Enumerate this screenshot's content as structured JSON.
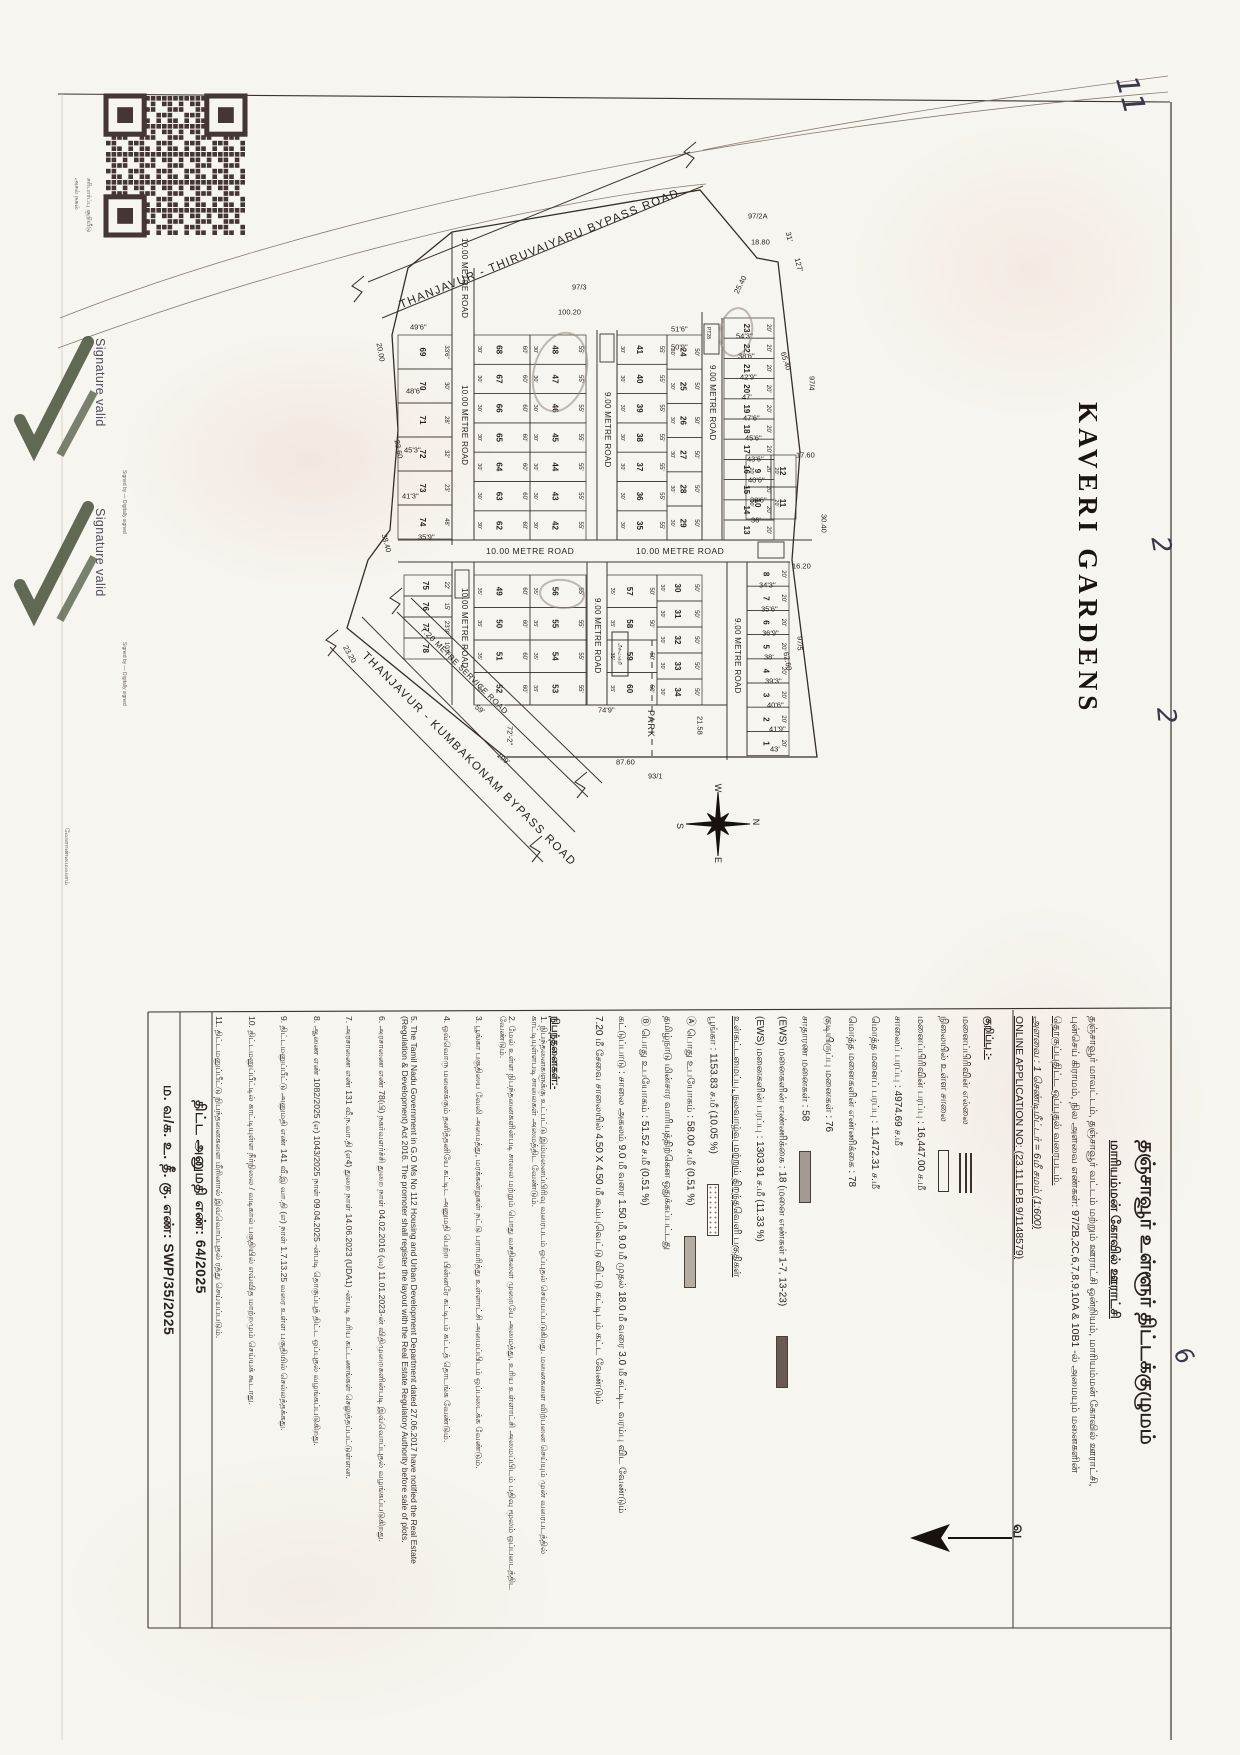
{
  "map": {
    "title_vertical": "KAVERI GARDENS",
    "park_label": "PARK",
    "north_label": "வ",
    "compass_letters": [
      "W",
      "N",
      "S",
      "E"
    ],
    "road_labels": [
      {
        "text": "THANJAVUR - THIRUVAIYARU BYPASS ROAD",
        "x": 398,
        "y": 300,
        "r": -22,
        "s": 11.5,
        "ls": 1.5
      },
      {
        "text": "THANJAVUR - KUMBAKONAM BYPASS ROAD",
        "x": 368,
        "y": 650,
        "r": 45,
        "s": 11.5,
        "ls": 1.5
      },
      {
        "text": "7.20 METRE SERVICE ROAD",
        "x": 425,
        "y": 625,
        "r": 45,
        "s": 8,
        "ls": 0.5
      },
      {
        "text": "10.00 METRE ROAD",
        "x": 469,
        "y": 238,
        "r": 90,
        "s": 8,
        "ls": 0.3
      },
      {
        "text": "10.00 METRE ROAD",
        "x": 469,
        "y": 385,
        "r": 90,
        "s": 8,
        "ls": 0.3
      },
      {
        "text": "10.00 METRE ROAD",
        "x": 469,
        "y": 588,
        "r": 90,
        "s": 8,
        "ls": 0.3
      },
      {
        "text": "9.00 METRE ROAD",
        "x": 612,
        "y": 392,
        "r": 90,
        "s": 8,
        "ls": 0.3
      },
      {
        "text": "9.00 METRE ROAD",
        "x": 602,
        "y": 598,
        "r": 90,
        "s": 8,
        "ls": 0.3
      },
      {
        "text": "9.00 METRE ROAD",
        "x": 717,
        "y": 365,
        "r": 90,
        "s": 8,
        "ls": 0.3
      },
      {
        "text": "9.00 METRE ROAD",
        "x": 742,
        "y": 618,
        "r": 90,
        "s": 8,
        "ls": 0.3
      },
      {
        "text": "10.00 METRE ROAD",
        "x": 486,
        "y": 546,
        "r": 0,
        "s": 8.5,
        "ls": 0.5
      },
      {
        "text": "10.00 METRE ROAD",
        "x": 636,
        "y": 546,
        "r": 0,
        "s": 8.5,
        "ls": 0.5
      },
      {
        "text": "PT28",
        "x": 711,
        "y": 327,
        "r": 90,
        "s": 5,
        "ls": 0
      }
    ],
    "survey_dims": [
      [
        "97/2A",
        748,
        216,
        0
      ],
      [
        "18.80",
        751,
        242,
        0
      ],
      [
        "31'",
        788,
        232,
        75
      ],
      [
        "127'",
        797,
        258,
        75
      ],
      [
        "25.40",
        736,
        293,
        -63
      ],
      [
        "97/3",
        572,
        287,
        0
      ],
      [
        "100.20",
        558,
        312,
        0
      ],
      [
        "65.40",
        783,
        352,
        72
      ],
      [
        "97/4",
        812,
        376,
        90
      ],
      [
        "17.60",
        796,
        455,
        0
      ],
      [
        "30.40",
        824,
        514,
        90
      ],
      [
        "16.20",
        792,
        566,
        0
      ],
      [
        "62.60",
        786,
        652,
        80
      ],
      [
        "97/5",
        800,
        636,
        90
      ],
      [
        "21.58",
        700,
        716,
        90
      ],
      [
        "87.60",
        616,
        762,
        0
      ],
      [
        "93/1",
        648,
        776,
        0
      ],
      [
        "74'9\"",
        598,
        710,
        0
      ],
      [
        "72'-2\"",
        510,
        726,
        90
      ],
      [
        "109'",
        498,
        754,
        40
      ],
      [
        "59'",
        476,
        706,
        40
      ],
      [
        "38.40",
        384,
        534,
        75
      ],
      [
        "23.60",
        397,
        440,
        80
      ],
      [
        "20.00",
        379,
        343,
        80
      ],
      [
        "23.20",
        345,
        646,
        60
      ],
      [
        "49'6\"",
        410,
        327,
        0
      ],
      [
        "48'6\"",
        406,
        391,
        0
      ],
      [
        "45'3\"",
        404,
        450,
        0
      ],
      [
        "41'3\"",
        402,
        496,
        0
      ],
      [
        "35'9\"",
        418,
        537,
        0
      ],
      [
        "51'6\"",
        671,
        329,
        0
      ],
      [
        "50'9\"",
        671,
        347,
        0
      ],
      [
        "54'3\"",
        736,
        336,
        0
      ],
      [
        "38'6\"",
        738,
        356,
        0
      ],
      [
        "42'9\"",
        740,
        377,
        0
      ],
      [
        "47'",
        742,
        397,
        0
      ],
      [
        "47'6\"",
        743,
        418,
        0
      ],
      [
        "45'6\"",
        745,
        438,
        0
      ],
      [
        "43'6\"",
        747,
        459,
        0
      ],
      [
        "40'6\"",
        748,
        480,
        0
      ],
      [
        "38'6\"",
        750,
        500,
        0
      ],
      [
        "36'",
        751,
        520,
        0
      ],
      [
        "34'3\"",
        759,
        585,
        0
      ],
      [
        "35'6\"",
        761,
        609,
        0
      ],
      [
        "36'9\"",
        762,
        633,
        0
      ],
      [
        "38'",
        764,
        657,
        0
      ],
      [
        "39'3\"",
        765,
        681,
        0
      ],
      [
        "40'6\"",
        767,
        705,
        0
      ],
      [
        "41'9\"",
        769,
        729,
        0
      ],
      [
        "43'",
        770,
        749,
        0
      ]
    ],
    "blocks": [
      {
        "x": 398,
        "y": 335,
        "w": 54,
        "h": 34,
        "plots": [
          "69",
          "70",
          "71",
          "72",
          "73",
          "74"
        ],
        "dims": [
          "33'6\"",
          "30'",
          "28'",
          "32'",
          "23'",
          "48'"
        ],
        "side": ""
      },
      {
        "x": 474,
        "y": 335,
        "w": 56,
        "h": 29.3,
        "plots": [
          "68",
          "67",
          "66",
          "65",
          "64",
          "63",
          "62"
        ],
        "dim": "60'",
        "side": "30'"
      },
      {
        "x": 530,
        "y": 335,
        "w": 56,
        "h": 29.3,
        "plots": [
          "48",
          "47",
          "46",
          "45",
          "44",
          "43",
          "42"
        ],
        "dim": "55'",
        "side": "30'"
      },
      {
        "x": 617,
        "y": 335,
        "w": 50,
        "h": 29.3,
        "plots": [
          "41",
          "40",
          "39",
          "38",
          "37",
          "36",
          "35"
        ],
        "dim": "55'",
        "side": "30'"
      },
      {
        "x": 667,
        "y": 335,
        "w": 35,
        "h": 34.2,
        "plots": [
          "24",
          "25",
          "26",
          "27",
          "28",
          "29"
        ],
        "dim": "50'",
        "side": "30'"
      },
      {
        "x": 724,
        "y": 318,
        "w": 50,
        "h": 20.2,
        "plots": [
          "23",
          "22",
          "21",
          "20",
          "19",
          "18",
          "17",
          "16",
          "15",
          "14",
          "13"
        ],
        "dim": "20'",
        "side": ""
      },
      {
        "x": 746,
        "y": 455,
        "w": 25,
        "h": 32,
        "plots": [
          "9",
          "10"
        ],
        "dim": "",
        "side": "20'"
      },
      {
        "x": 771,
        "y": 455,
        "w": 25,
        "h": 32,
        "plots": [
          "12",
          "11"
        ],
        "dim": "",
        "side": "20'"
      },
      {
        "x": 474,
        "y": 575,
        "w": 56,
        "h": 32.5,
        "plots": [
          "49",
          "50",
          "51",
          "52"
        ],
        "dim": "60'",
        "side": "35'"
      },
      {
        "x": 530,
        "y": 575,
        "w": 56,
        "h": 32.5,
        "plots": [
          "56",
          "55",
          "54",
          "53"
        ],
        "dim": "55'",
        "side": "35'"
      },
      {
        "x": 607,
        "y": 575,
        "w": 50,
        "h": 32.5,
        "plots": [
          "57",
          "58",
          "59",
          "60"
        ],
        "dim": "50'",
        "side": "35'"
      },
      {
        "x": 657,
        "y": 575,
        "w": 45,
        "h": 26,
        "plots": [
          "30",
          "31",
          "32",
          "33",
          "34"
        ],
        "dim": "50'",
        "side": "30'"
      },
      {
        "x": 404,
        "y": 575,
        "w": 48,
        "h": 21,
        "plots": [
          "75",
          "76",
          "77",
          "78"
        ],
        "dims": [
          "22'",
          "15'",
          "23'9\"",
          "10'9\""
        ],
        "side": ""
      },
      {
        "x": 747,
        "y": 562,
        "w": 42,
        "h": 24.2,
        "plots": [
          "8",
          "7",
          "6",
          "5",
          "4",
          "3",
          "2",
          "1"
        ],
        "dim": "20'",
        "side": ""
      }
    ],
    "transformer_label": "மின்மாற்றி"
  },
  "qr": {
    "captions": [
      "அசல் நகல்",
      "சரிபார்ப்பு குறியீடு"
    ]
  },
  "signature_stamp": {
    "text": "Signature valid",
    "caption": "Signed by — Digitally signed"
  },
  "left_margin_note": "வேளாண்மைவளம்",
  "handwriting": [
    {
      "t": "11",
      "x": 1142,
      "y": 72,
      "r": 75,
      "s": 30
    },
    {
      "t": "2",
      "x": 1174,
      "y": 534,
      "r": 80,
      "s": 26
    },
    {
      "t": "2",
      "x": 1180,
      "y": 706,
      "r": 85,
      "s": 26
    },
    {
      "t": "6",
      "x": 1192,
      "y": 1342,
      "r": 60,
      "s": 24
    }
  ],
  "bottom": {
    "title": "தஞ்சாவூர் உள்ளூர் திட்டக்குழுமம்",
    "subtitle": "மாரியம்மன் கோவில் ஊராட்சி",
    "description": [
      "தஞ்சாவூர் மாவட்டம், தஞ்சாவூர் வட்டம் மற்றும் ஊராட்சி ஒன்றியம், மாரியம்மன் கோவில் ஊராட்சி,",
      "புன்செய் கிராமம், நில அளவை எண்கள்: 97/2B,2C,6,7,8,9,10A & 10B1 -ல் அமையும் மனைகளின்",
      "தொகுப்புதிட்ட ஒப்புதல் வரைபடம்."
    ],
    "scale": "அளவை : 1 செண்டிமீட்டர் = 6மீ சமம் (1:600)",
    "application_no": "ONLINE APPLICATION NO: (23.11.LP.B.9/1148579)",
    "legend_heading": "குறிப்பு :-",
    "stats": [
      {
        "label": "மனைப்பிரிவின் எல்லை",
        "value": "",
        "sym": "triple"
      },
      {
        "label": "நிலையில் உள்ள சாலை",
        "value": "",
        "sym": "rect"
      },
      {
        "label": "மனைப்பிரிவின் பரப்பு",
        "value": "16,447.00 ச.மீ"
      },
      {
        "label": "சாலைப் பரப்பு",
        "value": "4974.69 ச.மீ"
      },
      {
        "label": "மொத்த மனைப் பரப்பு",
        "value": "11,472.31 ச.மீ"
      },
      {
        "label": "மொத்த மனைகளின் எண்ணிக்கை",
        "value": "78"
      },
      {
        "label": "குடியிருப்பு மனைகள்",
        "value": "76"
      },
      {
        "label": "சாதாரண மனைகள்",
        "value": "58",
        "swatch": "gray"
      },
      {
        "label": "(EWS) மனைகளின் எண்ணிக்கை",
        "value": "18 (மனை எண்கள் 1-7, 13-23)",
        "swatch": "dark"
      },
      {
        "label": "(EWS) மனைகளின் பரப்பு",
        "value": "1303.91 ச.மீ (11.33 %)"
      },
      {
        "label": "உள்கட்டமைப்பு, நலவாழ்வு மற்றும் திறந்தவெளி பகுதிகள்",
        "value": "",
        "underline": true
      },
      {
        "label": "பூங்கா",
        "value": "1153.83 ச.மீ (10.05 %)",
        "swatch": "dotted"
      },
      {
        "label": "Ⓐ பொது உபயோகம்",
        "value": "58.00 ச.மீ (0.51 %)",
        "swatch": "gray2"
      },
      {
        "label": "தமிழ்நாடு மின்சார வாரியத்திற்கென ஒதுக்கப்பட்டது",
        "value": ""
      },
      {
        "label": "Ⓑ பொது உபயோகம்",
        "value": "51.52 ச.மீ (0.51 %)"
      },
      {
        "label": "கட்டுப்பாடு : சாலை அகலம் 9.0 மீ வரை 1.50 மீ, 9.0 மீ முதல் 18.0 மீ வரை 3.0 மீ கட்டிட வரம்பு விட வேண்டும்",
        "value": ""
      },
      {
        "label": "7.20 மீ சேவை சாலையில் 4.50 X 4.50 மீ கூம்புவெட்டு விட்டு கட்டிடம் கட்ட வேண்டும்",
        "value": ""
      }
    ],
    "conditions_heading": "நிபந்தனைகள்:-",
    "conditions": [
      "நிபந்தனைகளுக்கு உட்பட்டு இம்மனைப்பிரிவு வரைபடம் ஒப்புதல் செய்யப்படுகிறது. மனைகளை விற்பனை செய்யும் முன் வரைபடத்தில் காட்டியுள்ளபடி சாலைகள் அமைத்திட வேண்டும்.",
      "மேல் உள்ள நிபந்தனைகளின்படி சாலை மற்றும் பொது வசதிகளை முறையே அமைத்து, உரிய உள்ளாட்சி அமைப்பிடம் பதிவு மூலம் ஒப்படைத்திட வேண்டும்.",
      "பூங்கா பகுதியை வேலி அமைத்து, மரக்கன்றுகள் நட்டு பராமரித்து உள்ளாட்சி அமைப்பிடம் ஒப்படைக்க வேண்டும்.",
      "ஒவ்வொரு மனைக்கும் தனித்தனியே கட்டிட அனுமதி பெற்ற பின்னரே கட்டிடம் கட்டத் தொடங்க வேண்டும்.",
      "The Tamil Nadu Government in G.O Ms No 112 Housing and Urban Development Department dated 27.06.2017 have notified the Real Estate (Regulation & Development) Act 2016. The promoter shall register the layout with the Real Estate Regulatory Authority before sale of plots.",
      "அரசாணை எண் 78(பி) நகர்வளர்ச்சி துறை நாள் 04.02.2016 (வ) 11.01.2023-ன் விதிமுறைகளின்படி இவ்வொப்புதல் வழங்கப்படுகிறது.",
      "அரசாணை எண் 131 வீ.ந.வா.தி (எ4) துறை நாள் 14.06.2023 (UDA1) -ன்படி உரிய கட்டணங்கள் செலுத்தப்பட்டுள்ளன.",
      "ஆணை எண் 1082/2025 (எ) 1043/2025 நாள் 09.04.2025 -ன்படி தொகுப்புத் திட்ட ஒப்புதல் வழங்கப்படுகிறது.",
      "திட்டமனுப்பீட்டு அனுமதி எண் 141 வீ.இ வா.தி (எ) நாள் 1.7.13.25 வரை உள்ள பகுதியில் செல்லத்தக்கது.",
      "திட்டமனுப்பீட்டில் காட்டியுள்ள நீர்நிலை / வடிகால் பகுதியில் எவ்வித மாற்றமும் செய்யக் கூடாது.",
      "திட்டமனுப்பீட்டு நிபந்தனைகளை மீறினால் இவ்வொப்புதல் ரத்து செய்யப்படும்."
    ],
    "refs": [
      {
        "label": "ம. வ/க. உ. தீ. கு. எண்: SWP/35/2025"
      },
      {
        "label": "திட்ட அனுமதி எண்: 64/2025"
      }
    ]
  }
}
